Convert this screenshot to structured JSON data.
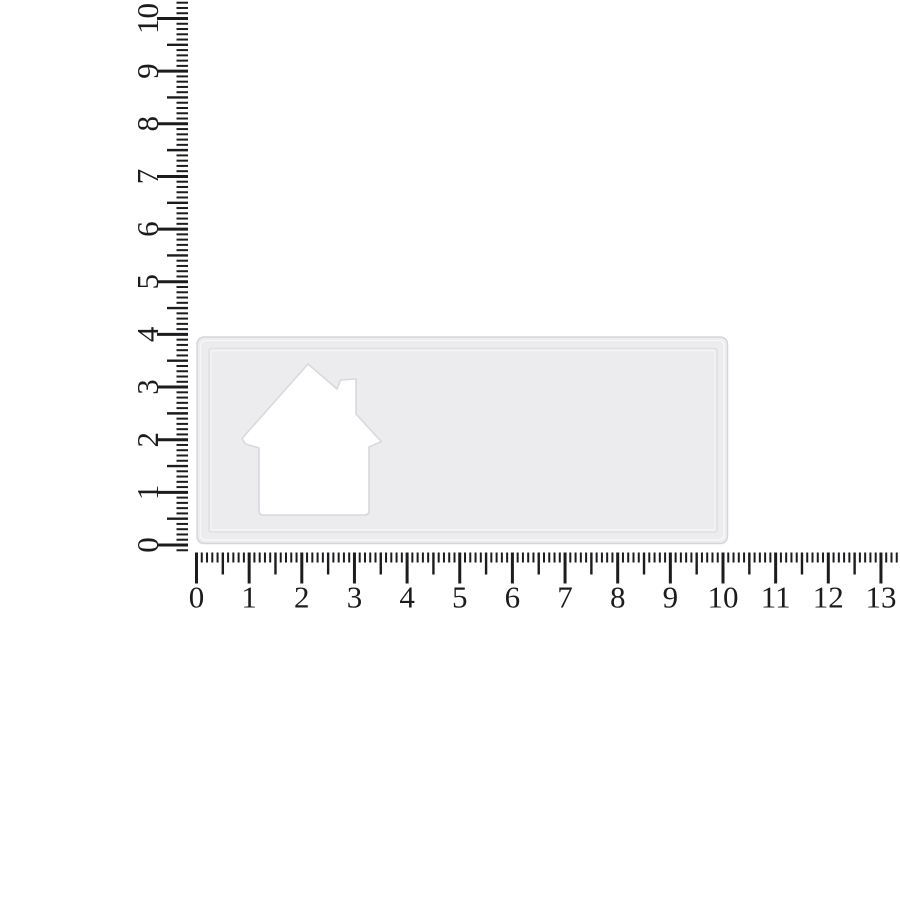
{
  "figure": {
    "kind": "ruler-measurement-exercise",
    "background_color": "#ffffff"
  },
  "rulers": {
    "tick_color": "#1c1c1e",
    "label_color": "#1c1c1e",
    "minor_ticks_per_unit": 10,
    "vertical": {
      "side": "left",
      "labels": [
        "0",
        "1",
        "2",
        "3",
        "4",
        "5",
        "6",
        "7",
        "8",
        "9",
        "10"
      ],
      "label_rotation_deg": -90,
      "visible_tick_range_units": [
        -0.1,
        10.35
      ]
    },
    "horizontal": {
      "side": "bottom",
      "labels": [
        "0",
        "1",
        "2",
        "3",
        "4",
        "5",
        "6",
        "7",
        "8",
        "9",
        "10",
        "11",
        "12",
        "13"
      ],
      "label_rotation_deg": 0,
      "visible_tick_range_units": [
        0,
        13.35
      ]
    }
  },
  "measured_object": {
    "name": "rectangular card with house-shaped cutout",
    "width_units": 10,
    "height_units": 4,
    "fill": "#ececee",
    "edge_color": "#d5d5d9",
    "rim_highlight": "#f6f6f8",
    "crease_color": "#e0e0e4",
    "crease_highlight": "#f5f5f7",
    "cutout_fill": "#ffffff",
    "cutout_edge_color": "#d9d9dd"
  }
}
